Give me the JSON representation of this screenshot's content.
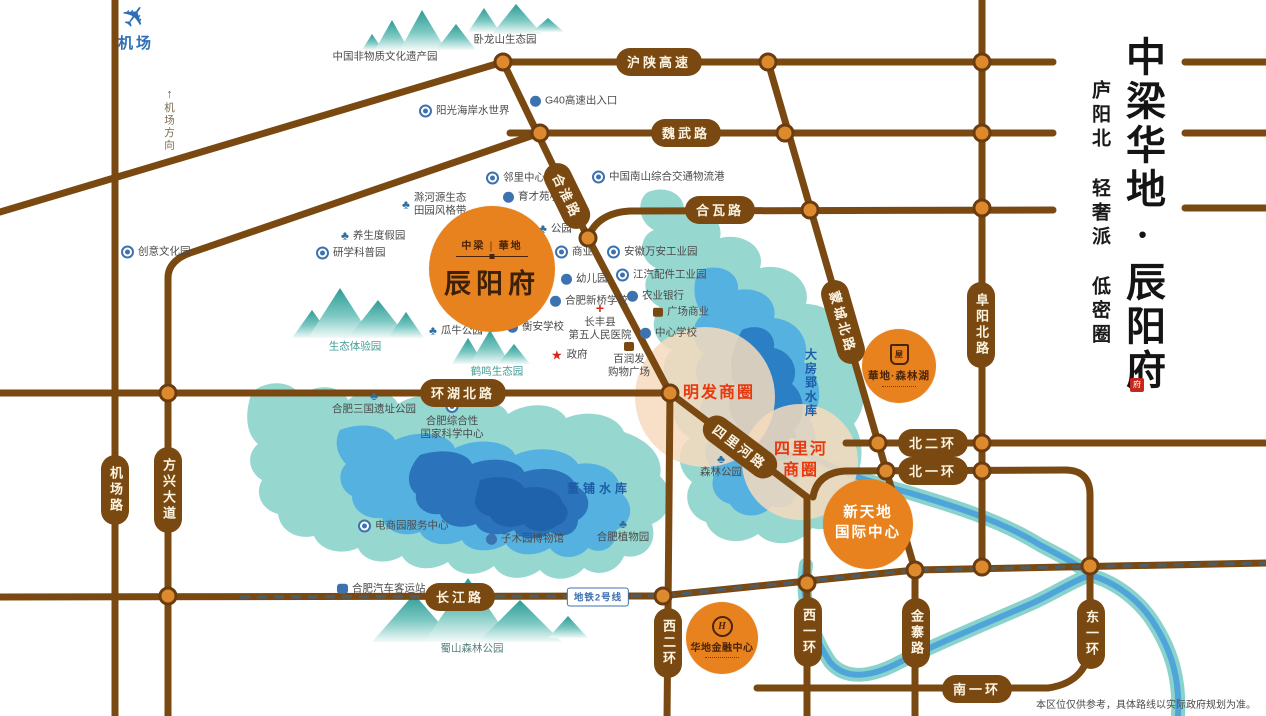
{
  "panel": {
    "title": "中梁华地·辰阳府",
    "subtitle": "庐阳北 轻奢派 低密圈",
    "seal": "府"
  },
  "disclaimer": "本区位仅供参考，具体路线以实际政府规划为准。",
  "airport": {
    "label": "机场",
    "direction": "机场方向"
  },
  "metro": {
    "label": "地铁2号线"
  },
  "colors": {
    "road": "#7A4912",
    "junction": "#DD8A2E",
    "brand_orange": "#E8821E",
    "zone_fill": "#F6DBBD",
    "zone_text": "#E8380D",
    "water_outer": "#96D8D0",
    "water_mid": "#55B1E0",
    "water_inner": "#2B7FC4",
    "water_text": "#1C5CA4",
    "metro_line": "#4E5D63",
    "poi_icon_blue": "#3C72B0"
  },
  "landmarks": {
    "chenyangfu": {
      "badge_top": "中梁 | 華地",
      "name": "辰阳府"
    },
    "senlinhu": {
      "name": "華地·森林湖"
    },
    "xintiandi": {
      "line1": "新天地",
      "line2": "国际中心"
    },
    "finance": {
      "name": "华地金融中心",
      "monogram": "H"
    }
  },
  "commercial_zones": [
    {
      "label": "明发商圈",
      "lines": [
        "明发商圈"
      ],
      "x": 719,
      "y": 394,
      "cx": 705,
      "cy": 397,
      "r": 70
    },
    {
      "label": "四里河商圈",
      "lines": [
        "四里河",
        "商圈"
      ],
      "x": 801,
      "y": 461,
      "cx": 800,
      "cy": 462,
      "r": 58
    }
  ],
  "road_labels": [
    {
      "label": "沪陕高速",
      "x": 659,
      "y": 62,
      "o": "h"
    },
    {
      "label": "魏武路",
      "x": 686,
      "y": 133,
      "o": "h"
    },
    {
      "label": "合瓦路",
      "x": 720,
      "y": 210,
      "o": "h"
    },
    {
      "label": "合淮路",
      "x": 567,
      "y": 196,
      "o": "h",
      "angle": 64
    },
    {
      "label": "环湖北路",
      "x": 463,
      "y": 393,
      "o": "h"
    },
    {
      "label": "蒙城北路",
      "x": 843,
      "y": 322,
      "o": "h",
      "angle": 74
    },
    {
      "label": "阜阳北路",
      "x": 981,
      "y": 325,
      "o": "v"
    },
    {
      "label": "北二环",
      "x": 933,
      "y": 443,
      "o": "h"
    },
    {
      "label": "北一环",
      "x": 933,
      "y": 471,
      "o": "h"
    },
    {
      "label": "四里河路",
      "x": 740,
      "y": 447,
      "o": "h",
      "angle": 37
    },
    {
      "label": "机场路",
      "x": 115,
      "y": 490,
      "o": "v"
    },
    {
      "label": "方兴大道",
      "x": 168,
      "y": 490,
      "o": "v"
    },
    {
      "label": "长江路",
      "x": 460,
      "y": 597,
      "o": "h"
    },
    {
      "label": "西二环",
      "x": 668,
      "y": 643,
      "o": "v"
    },
    {
      "label": "西一环",
      "x": 808,
      "y": 632,
      "o": "v"
    },
    {
      "label": "金寨路",
      "x": 916,
      "y": 633,
      "o": "v"
    },
    {
      "label": "东一环",
      "x": 1091,
      "y": 634,
      "o": "v"
    },
    {
      "label": "南一环",
      "x": 977,
      "y": 689,
      "o": "h"
    }
  ],
  "water_labels": [
    {
      "label": "大房郢水库",
      "x": 811,
      "y": 383,
      "o": "v"
    },
    {
      "label": "董铺水库",
      "x": 599,
      "y": 488,
      "o": "h"
    }
  ],
  "pois": [
    {
      "label": "阳光海岸水世界",
      "icon": "ring",
      "x": 425,
      "y": 111
    },
    {
      "label": "G40高速出入口",
      "icon": "badge",
      "x": 536,
      "y": 101
    },
    {
      "label": "邻里中心",
      "icon": "ring",
      "x": 492,
      "y": 178
    },
    {
      "label": "育才苑小学",
      "icon": "badge",
      "x": 509,
      "y": 197
    },
    {
      "label": "中国南山综合交通物流港",
      "icon": "ring",
      "x": 598,
      "y": 177
    },
    {
      "label": [
        "滁河源生态",
        "田园风格带"
      ],
      "icon": "tree",
      "x": 408,
      "y": 204
    },
    {
      "label": "养生度假园",
      "icon": "tree",
      "x": 347,
      "y": 236
    },
    {
      "label": "研学科普园",
      "icon": "ring",
      "x": 322,
      "y": 253
    },
    {
      "label": "创意文化园",
      "icon": "ring",
      "x": 127,
      "y": 252
    },
    {
      "label": "公园",
      "icon": "tree",
      "x": 545,
      "y": 229
    },
    {
      "label": "商业",
      "icon": "ring",
      "x": 561,
      "y": 252
    },
    {
      "label": "安徽万安工业园",
      "icon": "ring",
      "x": 613,
      "y": 252
    },
    {
      "label": "江汽配件工业园",
      "icon": "ring",
      "x": 622,
      "y": 275
    },
    {
      "label": "幼儿园",
      "icon": "badge",
      "x": 567,
      "y": 279
    },
    {
      "label": "合肥新桥学校",
      "icon": "badge",
      "x": 556,
      "y": 301
    },
    {
      "label": "农业银行",
      "icon": "badge",
      "x": 633,
      "y": 296
    },
    {
      "label": "广场商业",
      "icon": "cart",
      "x": 659,
      "y": 312
    },
    {
      "label": "衡安学校",
      "icon": "badge",
      "x": 513,
      "y": 327
    },
    {
      "label": [
        "长丰县",
        "第五人民医院"
      ],
      "icon": "cross",
      "x": 600,
      "y": 310,
      "layout": "below"
    },
    {
      "label": "中心学校",
      "icon": "badge",
      "x": 646,
      "y": 333
    },
    {
      "label": "瓜牛公园",
      "icon": "tree",
      "x": 435,
      "y": 331
    },
    {
      "label": "政府",
      "icon": "star",
      "x": 557,
      "y": 355
    },
    {
      "label": [
        "百润发",
        "购物广场"
      ],
      "icon": "cart",
      "x": 629,
      "y": 349,
      "layout": "below"
    },
    {
      "label": [
        "合肥综合性",
        "国家科学中心"
      ],
      "icon": "ring",
      "x": 452,
      "y": 407,
      "layout": "below"
    },
    {
      "label": "合肥三国遗址公园",
      "icon": "tree",
      "x": 374,
      "y": 398,
      "layout": "below"
    },
    {
      "label": "森林公园",
      "icon": "tree",
      "x": 721,
      "y": 461,
      "layout": "below"
    },
    {
      "label": "电商园服务中心",
      "icon": "ring",
      "x": 364,
      "y": 526
    },
    {
      "label": "子木园博物馆",
      "icon": "badge",
      "x": 492,
      "y": 539
    },
    {
      "label": "合肥植物园",
      "icon": "tree",
      "x": 623,
      "y": 526,
      "layout": "below"
    },
    {
      "label": "合肥汽车客运站",
      "icon": "bus",
      "x": 343,
      "y": 589
    },
    {
      "label": "中国非物质文化遗产园",
      "icon": "none",
      "x": 385,
      "y": 57,
      "layout": "plain",
      "color": "#4A4A4A"
    },
    {
      "label": "卧龙山生态园",
      "icon": "none",
      "x": 505,
      "y": 40,
      "layout": "plain",
      "color": "#4A4A4A"
    },
    {
      "label": "生态体验园",
      "icon": "none",
      "x": 355,
      "y": 347,
      "layout": "plain",
      "color": "#3F9D97"
    },
    {
      "label": "鹤鸣生态园",
      "icon": "none",
      "x": 497,
      "y": 372,
      "layout": "plain",
      "color": "#3F9D97"
    },
    {
      "label": "蜀山森林公园",
      "icon": "none",
      "x": 472,
      "y": 649,
      "layout": "plain",
      "color": "#58807C"
    }
  ]
}
